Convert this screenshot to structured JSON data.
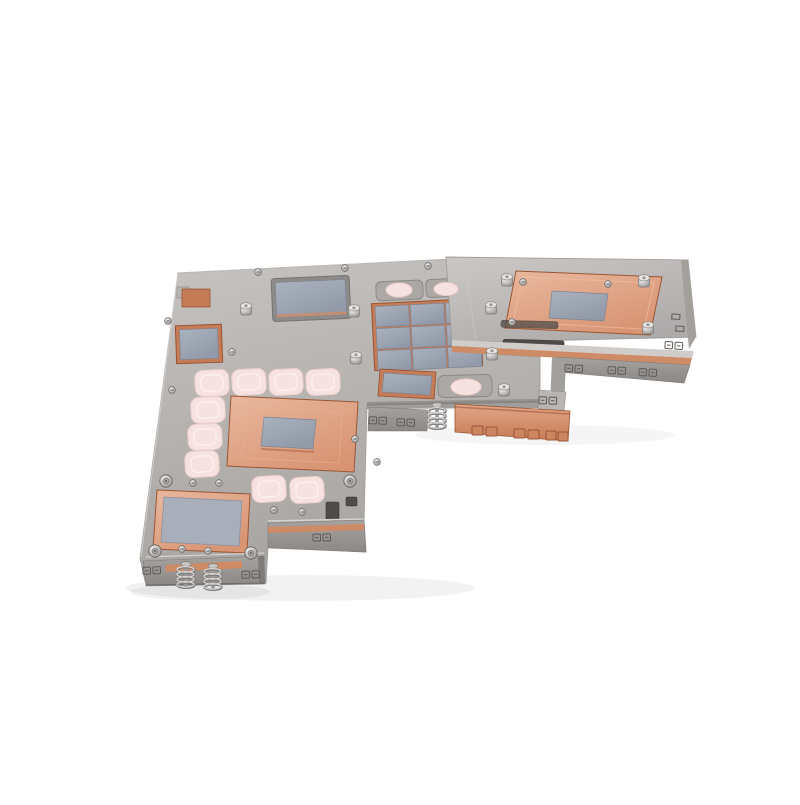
{
  "scene": {
    "type": "product-photo",
    "subject": "Nickel-plated GPU water-block cold plate with copper contact pads, gray thermal pads and pink thermal-paste dots on a white background",
    "background": "#ffffff"
  },
  "colors": {
    "background": "#ffffff",
    "plate_silver_light": "#c6c3c0",
    "plate_silver": "#b4b1ae",
    "plate_silver_dark": "#8f8c89",
    "apron_light": "#a5a29f",
    "apron_dark": "#8b8885",
    "edge_line": "#a09d9a",
    "copper_light": "#e9b89e",
    "copper": "#d89473",
    "copper_dark": "#b96f4c",
    "copper_frame": "#c67b57",
    "copper_strip": "#cf8a66",
    "pad_light": "#aab2bf",
    "pad": "#929aa9",
    "paste_pink": "#f6e2e0",
    "paste_pink_edge": "#eccfcb",
    "screw_bright": "#f2f1f0",
    "screw_dark": "#969492",
    "slot_dark": "#4e4b48",
    "stamp": "#5e5b58"
  },
  "parts": {
    "main_plate": "nickel-plated base plate",
    "right_arm": "raised right section",
    "gpu_copper_pad": "large central copper pad with gray die pad",
    "right_copper_pad": "large copper pad on right section with gray die pad",
    "bottom_copper_pad": "bottom-left copper pad with large gray thermal pad",
    "vram_pad_grid": "3x3 gray thermal pad grid on copper frame",
    "top_thermal_pad": "rectangular gray thermal pad at top",
    "left_thermal_pad": "small square thermal pad at left edge",
    "mid_thermal_pad": "small gray thermal pad on middle arm",
    "paste_dots": "pink thermal paste pads",
    "fin_block": "copper fin block on lower right arm",
    "springs": "spring-loaded mounting screws"
  },
  "elements": {
    "small_screws": [
      [
        258,
        272
      ],
      [
        345,
        268
      ],
      [
        428,
        266
      ],
      [
        168,
        321
      ],
      [
        232,
        352
      ],
      [
        172,
        390
      ],
      [
        355,
        439
      ],
      [
        377,
        462
      ],
      [
        193,
        483
      ],
      [
        219,
        483
      ],
      [
        182,
        549
      ],
      [
        208,
        551
      ],
      [
        523,
        282
      ],
      [
        274,
        510
      ],
      [
        302,
        512
      ],
      [
        608,
        284
      ],
      [
        512,
        322
      ]
    ],
    "socket_screws": [
      [
        166,
        481
      ],
      [
        350,
        481
      ],
      [
        155,
        551
      ],
      [
        251,
        553
      ]
    ],
    "standoffs": [
      [
        246,
        309
      ],
      [
        354,
        311
      ],
      [
        491,
        308
      ],
      [
        356,
        358
      ],
      [
        492,
        354
      ],
      [
        504,
        390
      ],
      [
        648,
        328
      ],
      [
        507,
        280
      ],
      [
        644,
        281
      ]
    ],
    "pink_pads": [
      [
        195,
        370
      ],
      [
        232,
        369
      ],
      [
        269,
        369
      ],
      [
        306,
        369
      ],
      [
        191,
        397
      ],
      [
        188,
        424
      ],
      [
        185,
        451
      ],
      [
        252,
        476
      ],
      [
        290,
        477
      ]
    ],
    "pink_ovals": [
      [
        399,
        290,
        13,
        7
      ],
      [
        446,
        289,
        12,
        6.5
      ],
      [
        466,
        387,
        15,
        8
      ]
    ],
    "springs": [
      [
        186,
        566
      ],
      [
        213,
        568
      ],
      [
        437,
        407
      ]
    ],
    "stamps": [
      [
        574,
        369,
        3
      ],
      [
        617,
        371,
        3
      ],
      [
        648,
        373,
        3
      ],
      [
        674,
        346,
        4
      ],
      [
        378,
        421,
        2
      ],
      [
        406,
        423,
        2
      ],
      [
        322,
        538,
        -1
      ],
      [
        152,
        571,
        -2
      ],
      [
        251,
        575,
        -2
      ],
      [
        548,
        401,
        2
      ]
    ],
    "edge_marks": [
      [
        672,
        314
      ],
      [
        676,
        326
      ]
    ]
  }
}
